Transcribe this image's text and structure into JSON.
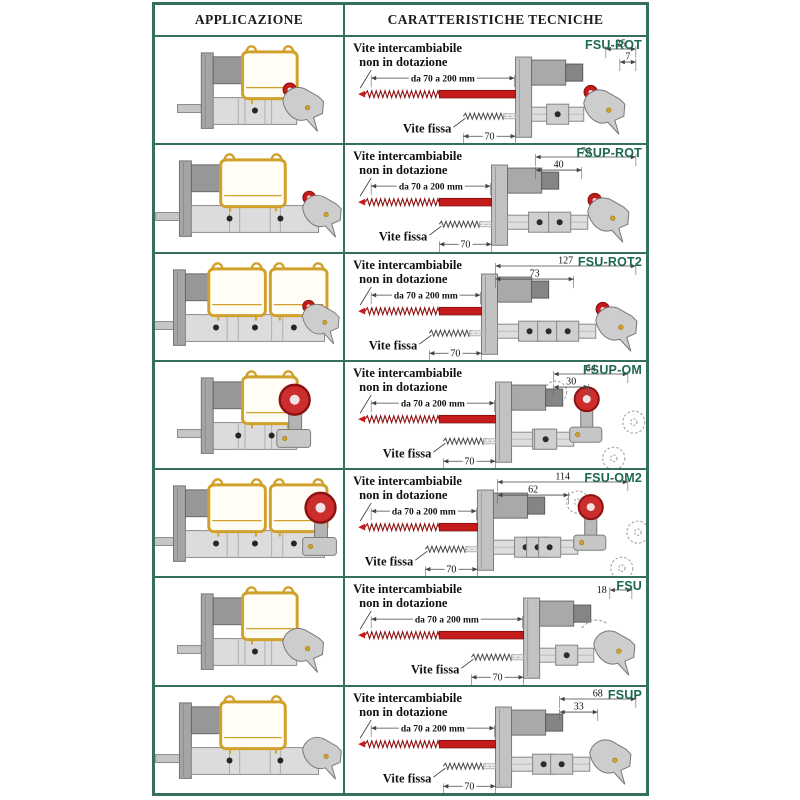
{
  "table": {
    "header": {
      "col1": "APPLICAZIONE",
      "col2": "CARATTERISTICHE TECNICHE"
    },
    "shared": {
      "interchangeable_line1": "Vite intercambiabile",
      "interchangeable_line2": "non in dotazione",
      "range_label": "da 70 a 200 mm",
      "fixed_label": "Vite fissa",
      "fixed_length": "70"
    },
    "rows": [
      {
        "code": "FSU-ROT",
        "dims": [
          "25",
          "7"
        ]
      },
      {
        "code": "FSUP-ROT",
        "dims": [
          "76",
          "40"
        ]
      },
      {
        "code": "FSU-ROT2",
        "dims": [
          "127",
          "73"
        ]
      },
      {
        "code": "FSUP-OM",
        "dims": [
          "64",
          "30"
        ]
      },
      {
        "code": "FSU-OM2",
        "dims": [
          "114",
          "62"
        ]
      },
      {
        "code": "FSU",
        "dims": [
          "18"
        ]
      },
      {
        "code": "FSUP",
        "dims": [
          "68",
          "33"
        ]
      }
    ],
    "colors": {
      "border": "#35705f",
      "code_text": "#1c6a4d",
      "screw_red": "#c41b1b",
      "screw_red_dark": "#8e1111",
      "rail_yellow": "#d2a12c",
      "metal_light": "#dcdcdc",
      "metal_mid": "#a5a5a5",
      "metal_dark": "#7b7b7b"
    }
  }
}
